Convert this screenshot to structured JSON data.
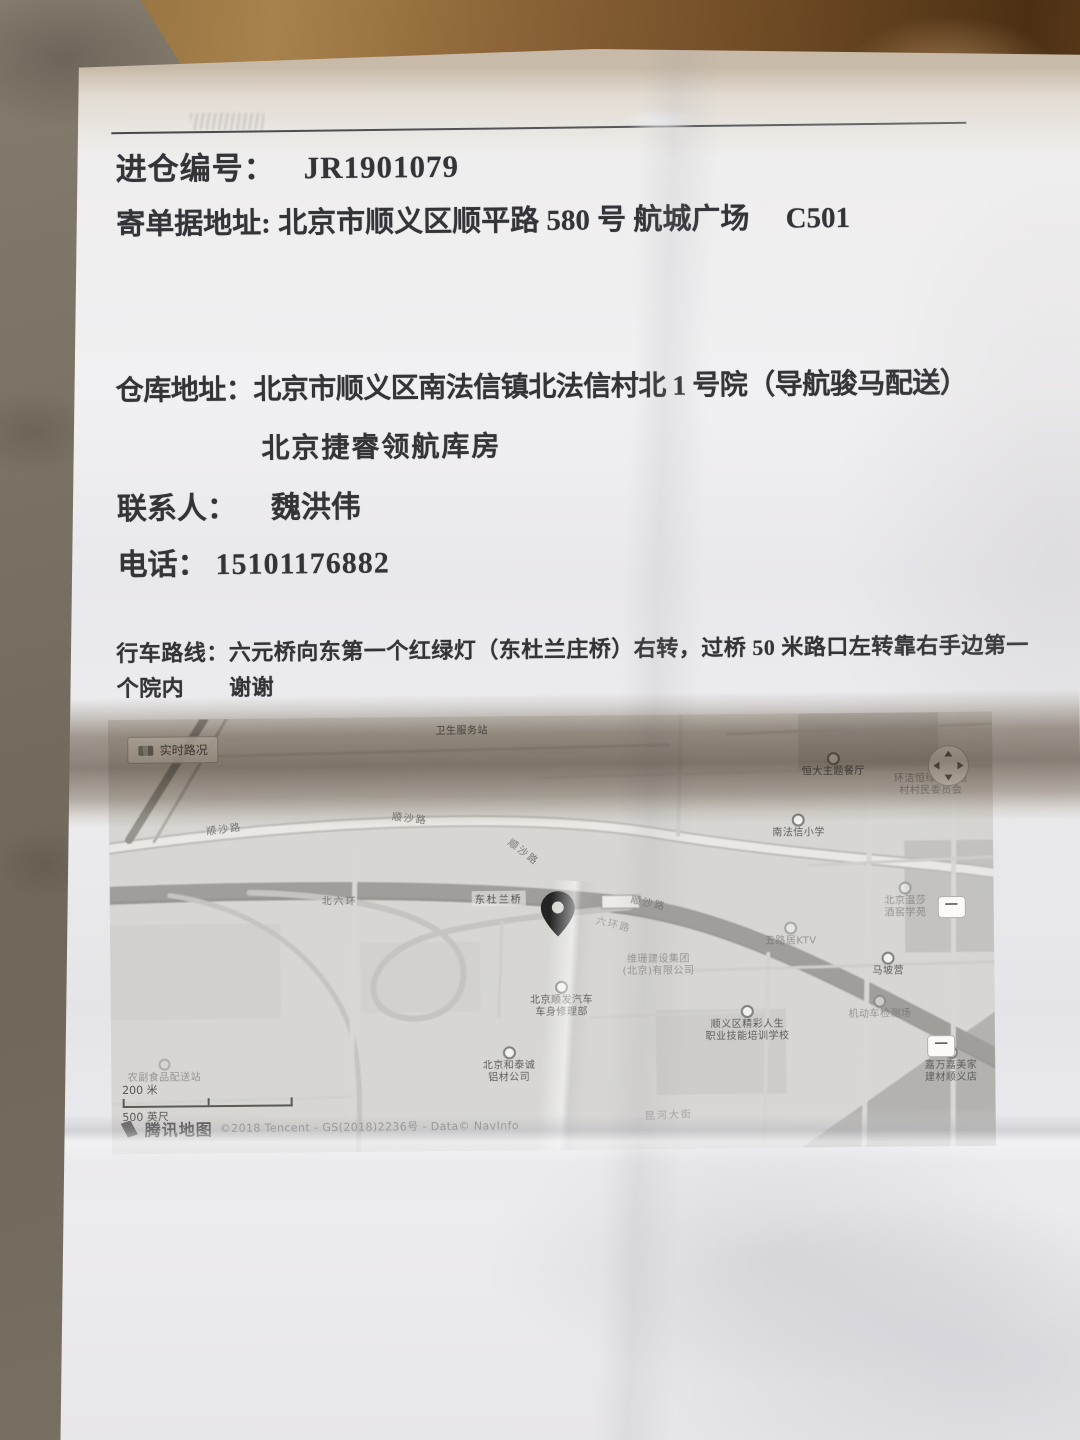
{
  "doc": {
    "entry_no_label": "进仓编号：",
    "entry_no": "JR1901079",
    "mail_addr_label": "寄单据地址:",
    "mail_addr": "北京市顺义区顺平路 580 号  航城广场　 C501",
    "wh_addr_label": "仓库地址：",
    "wh_addr": "北京市顺义区南法信镇北法信村北 1 号院（导航骏马配送）",
    "wh_name": "北京捷睿领航库房",
    "contact_label": "联系人：",
    "contact": "魏洪伟",
    "phone_label": "电话：",
    "phone": "15101176882",
    "route_label": "行车路线：",
    "route_line1": "六元桥向东第一个红绿灯（东杜兰庄桥）右转，过桥 50 米路口左转靠右手边第一",
    "route_line2": "个院内　　谢谢"
  },
  "map": {
    "traffic_label": "实时路况",
    "shield_label": "一",
    "scale_metric": "200 米",
    "scale_imperial": "500 英尺",
    "brand_name": "腾讯地图",
    "attribution": "©2018 Tencent - GS(2018)2236号 - Data© NavInfo",
    "pois": [
      {
        "x": 40,
        "y": 2,
        "cls": "poi",
        "lines": [
          "卫生服务站"
        ]
      },
      {
        "x": 13,
        "y": 25,
        "rot": -7,
        "cls": "road",
        "lines": [
          "顺沙路"
        ]
      },
      {
        "x": 34,
        "y": 23,
        "rot": 7,
        "cls": "road",
        "lines": [
          "顺沙路"
        ]
      },
      {
        "x": 47,
        "y": 31,
        "rot": 38,
        "cls": "road",
        "lines": [
          "顺沙路"
        ]
      },
      {
        "x": 61,
        "y": 43,
        "rot": 13,
        "cls": "road",
        "lines": [
          "顺沙路"
        ]
      },
      {
        "x": 26,
        "y": 42,
        "rot": 1,
        "cls": "road",
        "lines": [
          "北六环"
        ]
      },
      {
        "x": 44,
        "y": 42,
        "cls": "road dark",
        "lines": [
          "东杜兰桥"
        ]
      },
      {
        "x": 57,
        "y": 48,
        "rot": 14,
        "cls": "road faint",
        "lines": [
          "六环路"
        ]
      },
      {
        "x": 82,
        "y": 9,
        "cls": "poi",
        "icon": "dot",
        "lines": [
          "恒大主题餐厅"
        ]
      },
      {
        "x": 93,
        "y": 14,
        "cls": "poi faint",
        "lines": [
          "环洁恒绿化苗圃",
          "村村民委员会"
        ]
      },
      {
        "x": 78,
        "y": 23,
        "cls": "poi",
        "icon": "dot",
        "lines": [
          "南法信小学"
        ]
      },
      {
        "x": 90,
        "y": 39,
        "cls": "poi faint",
        "icon": "dot",
        "lines": [
          "北京温莎",
          "酒窖学苑"
        ]
      },
      {
        "x": 77,
        "y": 48,
        "cls": "poi faint",
        "icon": "dot",
        "lines": [
          "五路居KTV"
        ]
      },
      {
        "x": 62,
        "y": 55,
        "cls": "poi faint",
        "lines": [
          "维珊建设集团",
          "(北京)有限公司"
        ]
      },
      {
        "x": 51,
        "y": 61,
        "cls": "poi",
        "icon": "dot",
        "lines": [
          "北京顺发汽车",
          "车身修理部"
        ]
      },
      {
        "x": 72,
        "y": 67,
        "cls": "poi",
        "icon": "dot",
        "lines": [
          "顺义区精彩人生",
          "职业技能培训学校"
        ]
      },
      {
        "x": 88,
        "y": 55,
        "cls": "poi",
        "icon": "dot",
        "lines": [
          "马坡营"
        ]
      },
      {
        "x": 87,
        "y": 65,
        "cls": "poi faint",
        "icon": "dot",
        "lines": [
          "机动车检测场"
        ]
      },
      {
        "x": 45,
        "y": 76,
        "cls": "poi",
        "icon": "dot",
        "lines": [
          "北京和泰诚",
          "铝材公司"
        ]
      },
      {
        "x": 95,
        "y": 77,
        "cls": "poi",
        "icon": "dot",
        "lines": [
          "嘉万嘉美家",
          "建材顺义店"
        ]
      },
      {
        "x": 63,
        "y": 92,
        "rot": -2,
        "cls": "road faint",
        "lines": [
          "昆河大街"
        ]
      },
      {
        "x": 6,
        "y": 78,
        "cls": "poi faint",
        "icon": "ring",
        "lines": [
          "农副食品配送站"
        ]
      }
    ]
  }
}
